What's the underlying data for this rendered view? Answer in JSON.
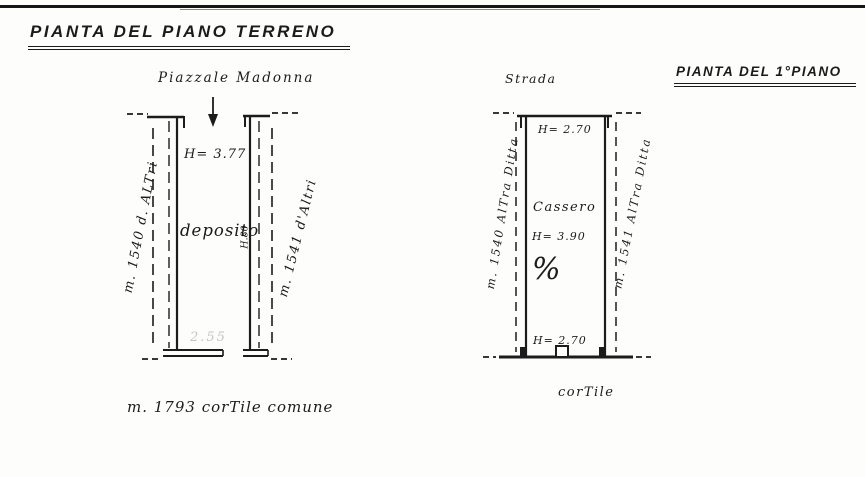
{
  "document": {
    "title_ground": "PIANTA DEL PIANO TERRENO",
    "title_first": "PIANTA DEL 1°PIANO"
  },
  "icons": {
    "down_arrow": "↓"
  },
  "ground_floor_plan": {
    "top_area_label": "Piazzale Madonna",
    "left_parcel_label": "m. 1540 d. ALTri",
    "right_parcel_label": "m. 1541 d'Altri",
    "ceiling_height": "H= 3.77",
    "room_name": "deposito",
    "door_height_note": "H.80",
    "faint_measure": "2.55",
    "courtyard_label": "m. 1793 corTile comune"
  },
  "first_floor_plan": {
    "top_area_label": "Strada",
    "left_parcel_label": "m. 1540 AlTra Ditta",
    "right_parcel_label": "m. 1541 AlTra Ditta",
    "ceiling_height_top": "H= 2.70",
    "room_name": "Cassero",
    "ceiling_height_mid": "H= 3.90",
    "slope_symbol": "%",
    "ceiling_height_bottom": "H= 2.70",
    "courtyard_label": "corTile"
  }
}
